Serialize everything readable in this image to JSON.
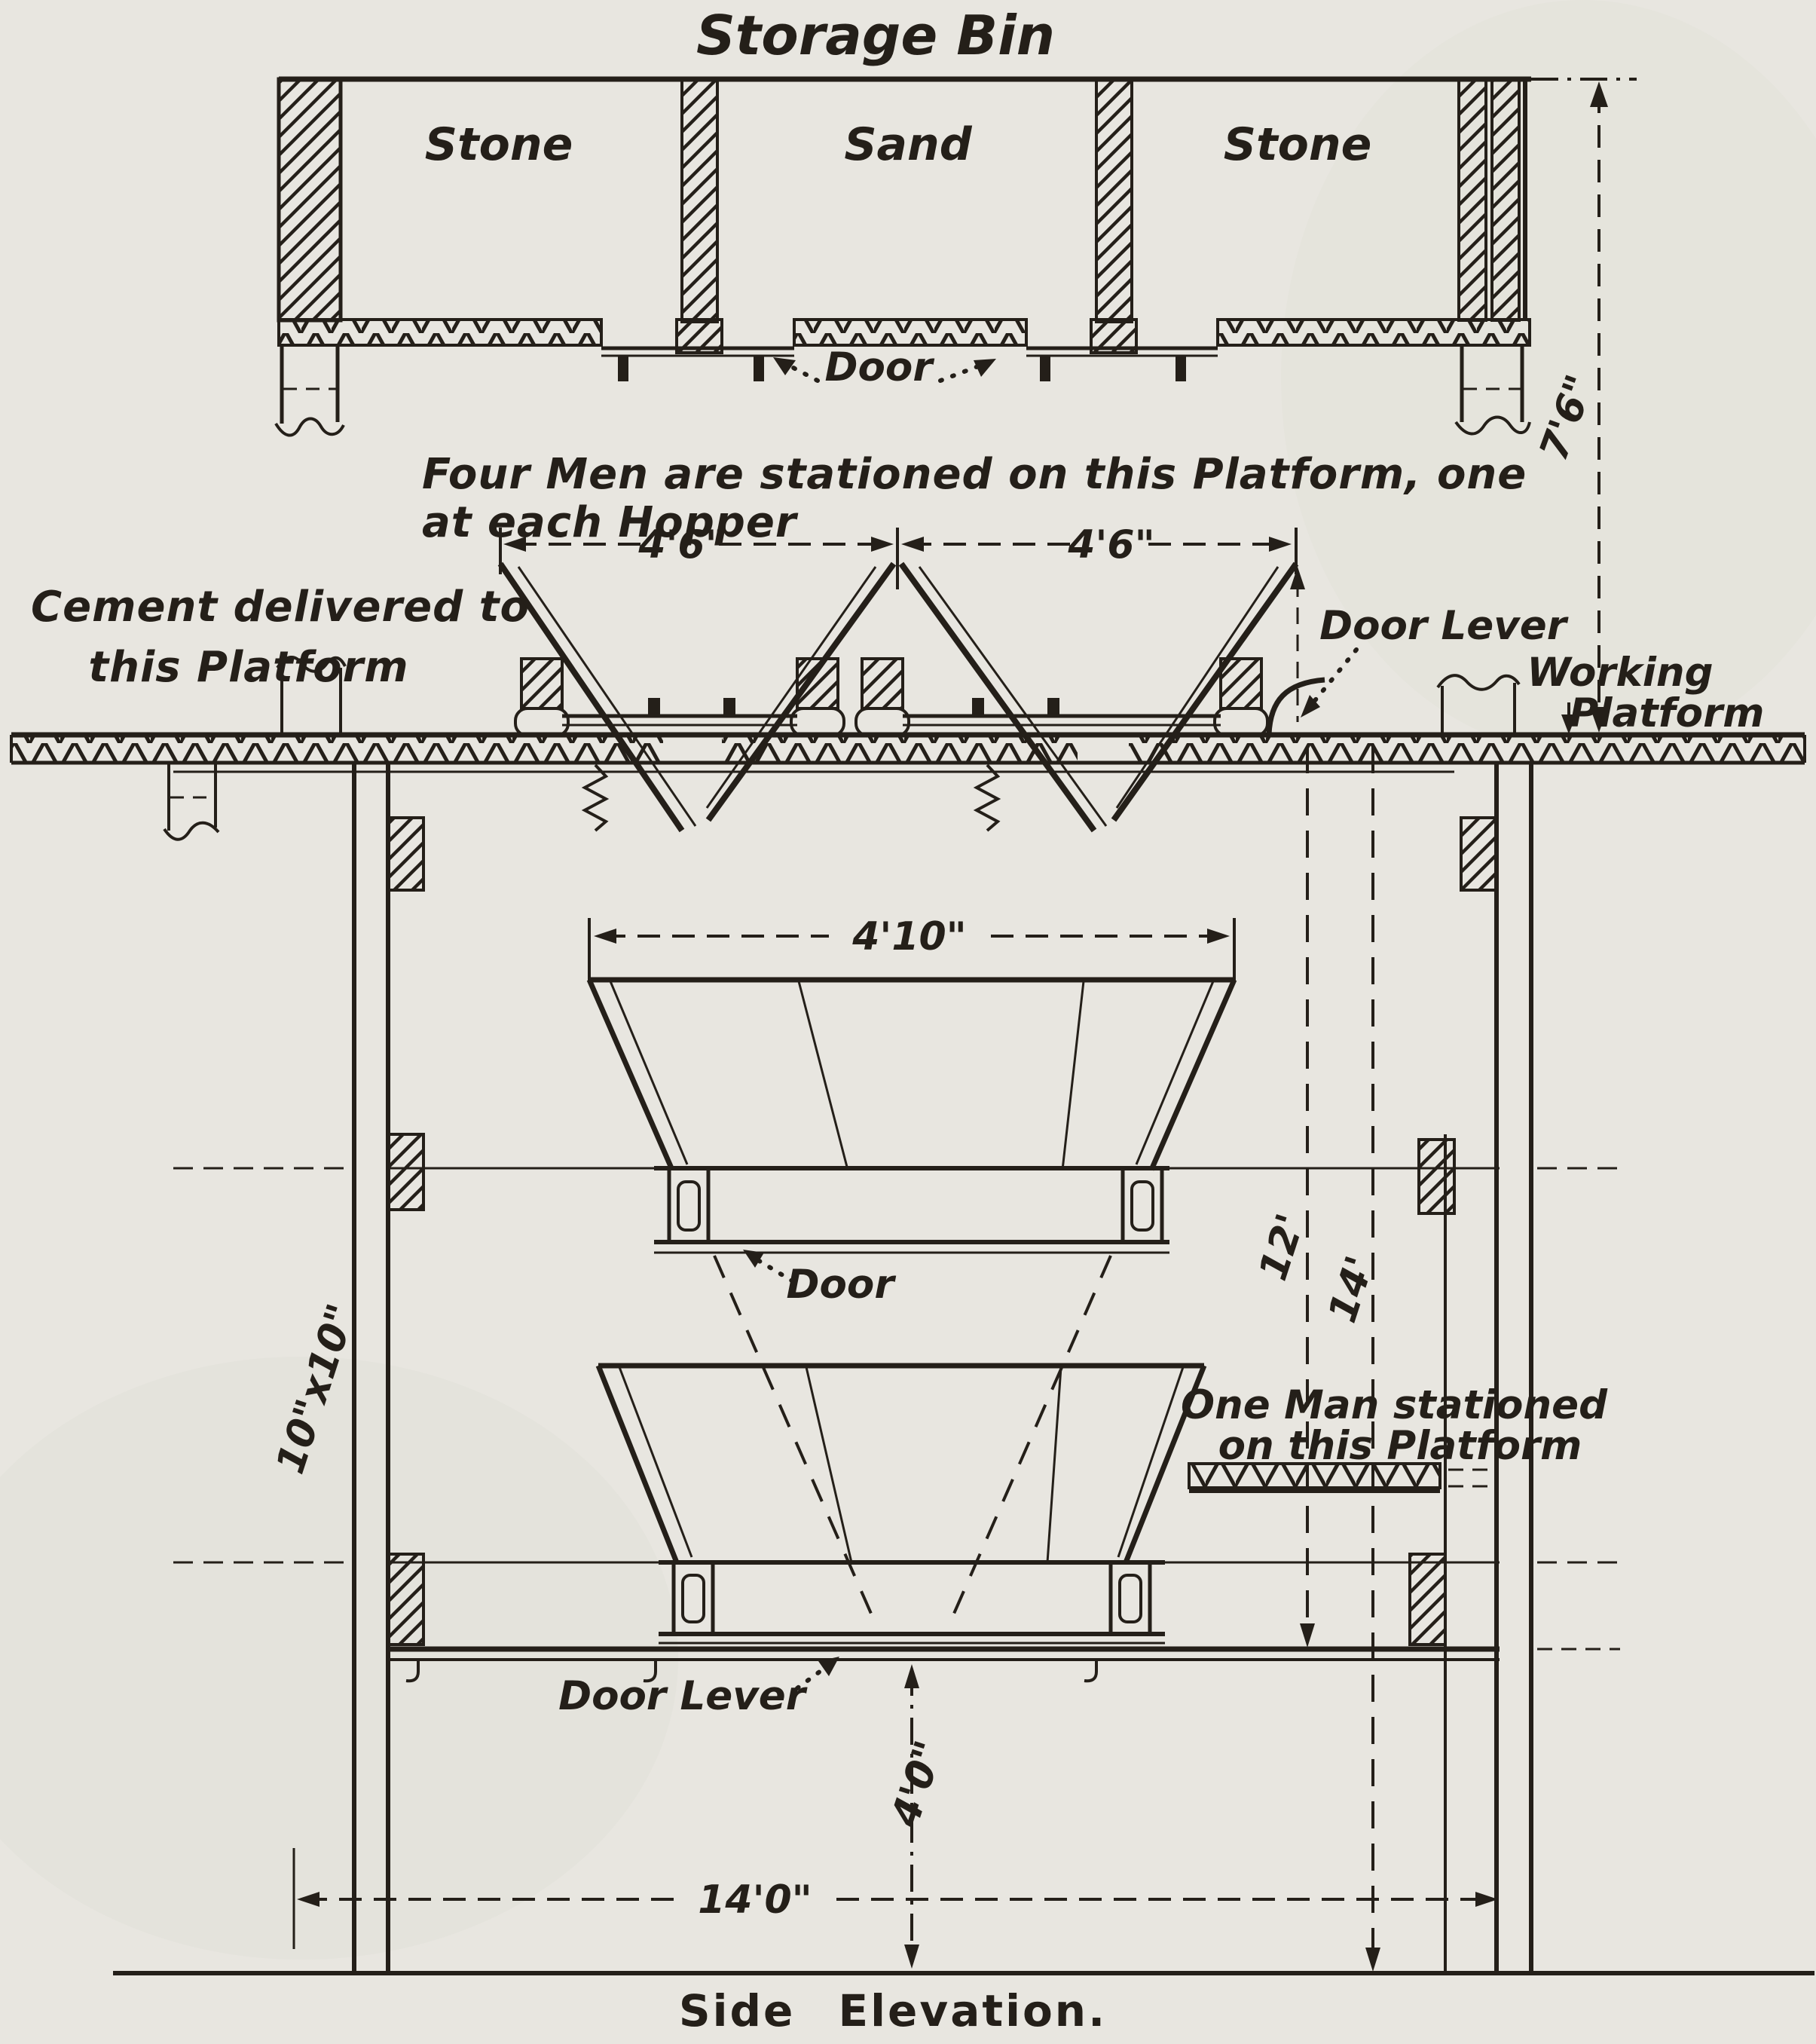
{
  "drawing": {
    "title": "Storage Bin",
    "caption": "Side Elevation.",
    "bins": {
      "left": "Stone",
      "middle": "Sand",
      "right": "Stone"
    },
    "labels": {
      "bin_door": "Door",
      "four_men_line1": "Four Men are stationed on this Platform, one",
      "four_men_line2": "at each Hopper",
      "cement_line1": "Cement delivered to",
      "cement_line2": "this Platform",
      "door_lever_upper": "Door Lever",
      "working_platform_line1": "Working",
      "working_platform_line2": "Platform",
      "hopper_door": "Door",
      "one_man_line1": "One Man stationed",
      "one_man_line2": "on this Platform",
      "door_lever_lower": "Door Lever"
    },
    "dimensions": {
      "bin_height": "7'6\"",
      "hopper_spacing_left": "4'6\"",
      "hopper_spacing_right": "4'6\"",
      "hopper_width": "4'10\"",
      "column_size": "10\"x10\"",
      "platform_to_lever_platform": "12'",
      "platform_to_ground": "14'",
      "discharge_clearance": "4'0\"",
      "frame_width": "14'0\""
    },
    "colors": {
      "ink": "#241f19",
      "paper": "#e8e6e0"
    }
  }
}
